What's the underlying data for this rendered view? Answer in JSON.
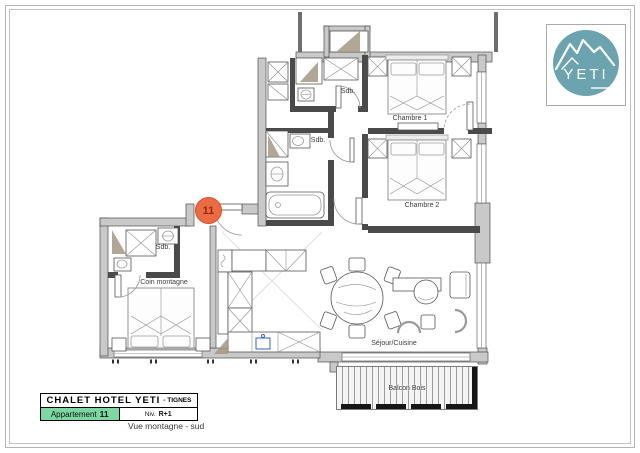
{
  "plan": {
    "rooms": {
      "chambre1": "Chambre 1",
      "chambre2": "Chambre 2",
      "sdb_top": "Sdb.",
      "sdb_mid": "Sdb.",
      "sdb_left": "Sdb.",
      "coin_montagne": "Coin montagne",
      "sejour_cuisine": "Séjour/Cuisine",
      "balcon": "Balcon Bois"
    },
    "entry_marker": "11"
  },
  "logo": {
    "text": "YETI"
  },
  "title_block": {
    "hotel_name": "CHALET HOTEL YETI",
    "hotel_suffix": "- TIGNES",
    "apartment_word": "Appartement",
    "apartment_number": "11",
    "level_word": "Niv.",
    "level_value": "R+1",
    "caption": "Vue montagne - sud"
  },
  "colors": {
    "wall_gray": "#c9c9c9",
    "partition_dark": "#4a4a4a",
    "marker_orange": "#EC6B42",
    "logo_teal": "#6BA4AF",
    "accent_green": "#7CD7A0"
  }
}
